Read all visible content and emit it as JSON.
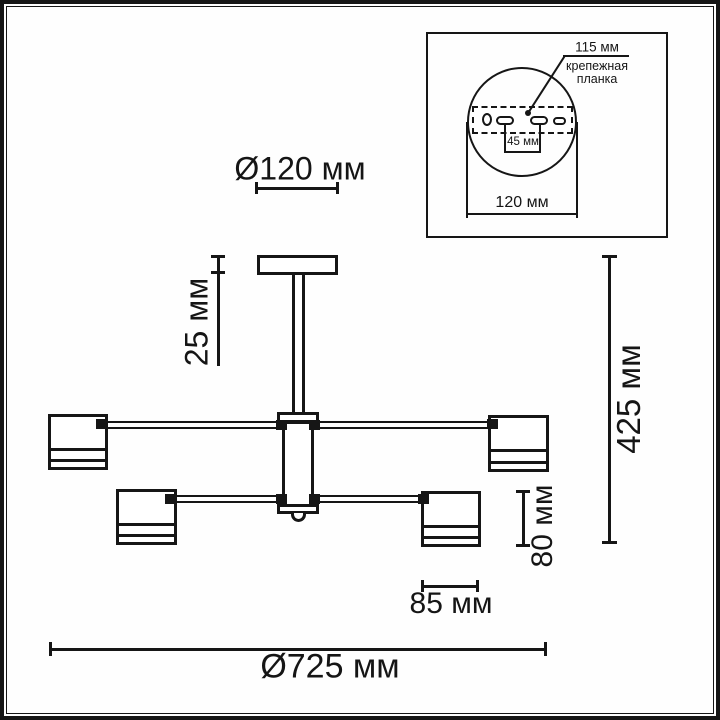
{
  "main_dimensions": {
    "canopy_diameter": "Ø120 мм",
    "canopy_height": "25 мм",
    "total_height": "425 мм",
    "shade_height": "80 мм",
    "shade_width": "85 мм",
    "total_diameter": "Ø725 мм"
  },
  "inset": {
    "mount_length": "115 мм",
    "bracket_label_line1": "крепежная",
    "bracket_label_line2": "планка",
    "hole_spacing": "45 мм",
    "plate_diameter": "120 мм"
  },
  "colors": {
    "line": "#161616",
    "background": "#fefefe"
  }
}
